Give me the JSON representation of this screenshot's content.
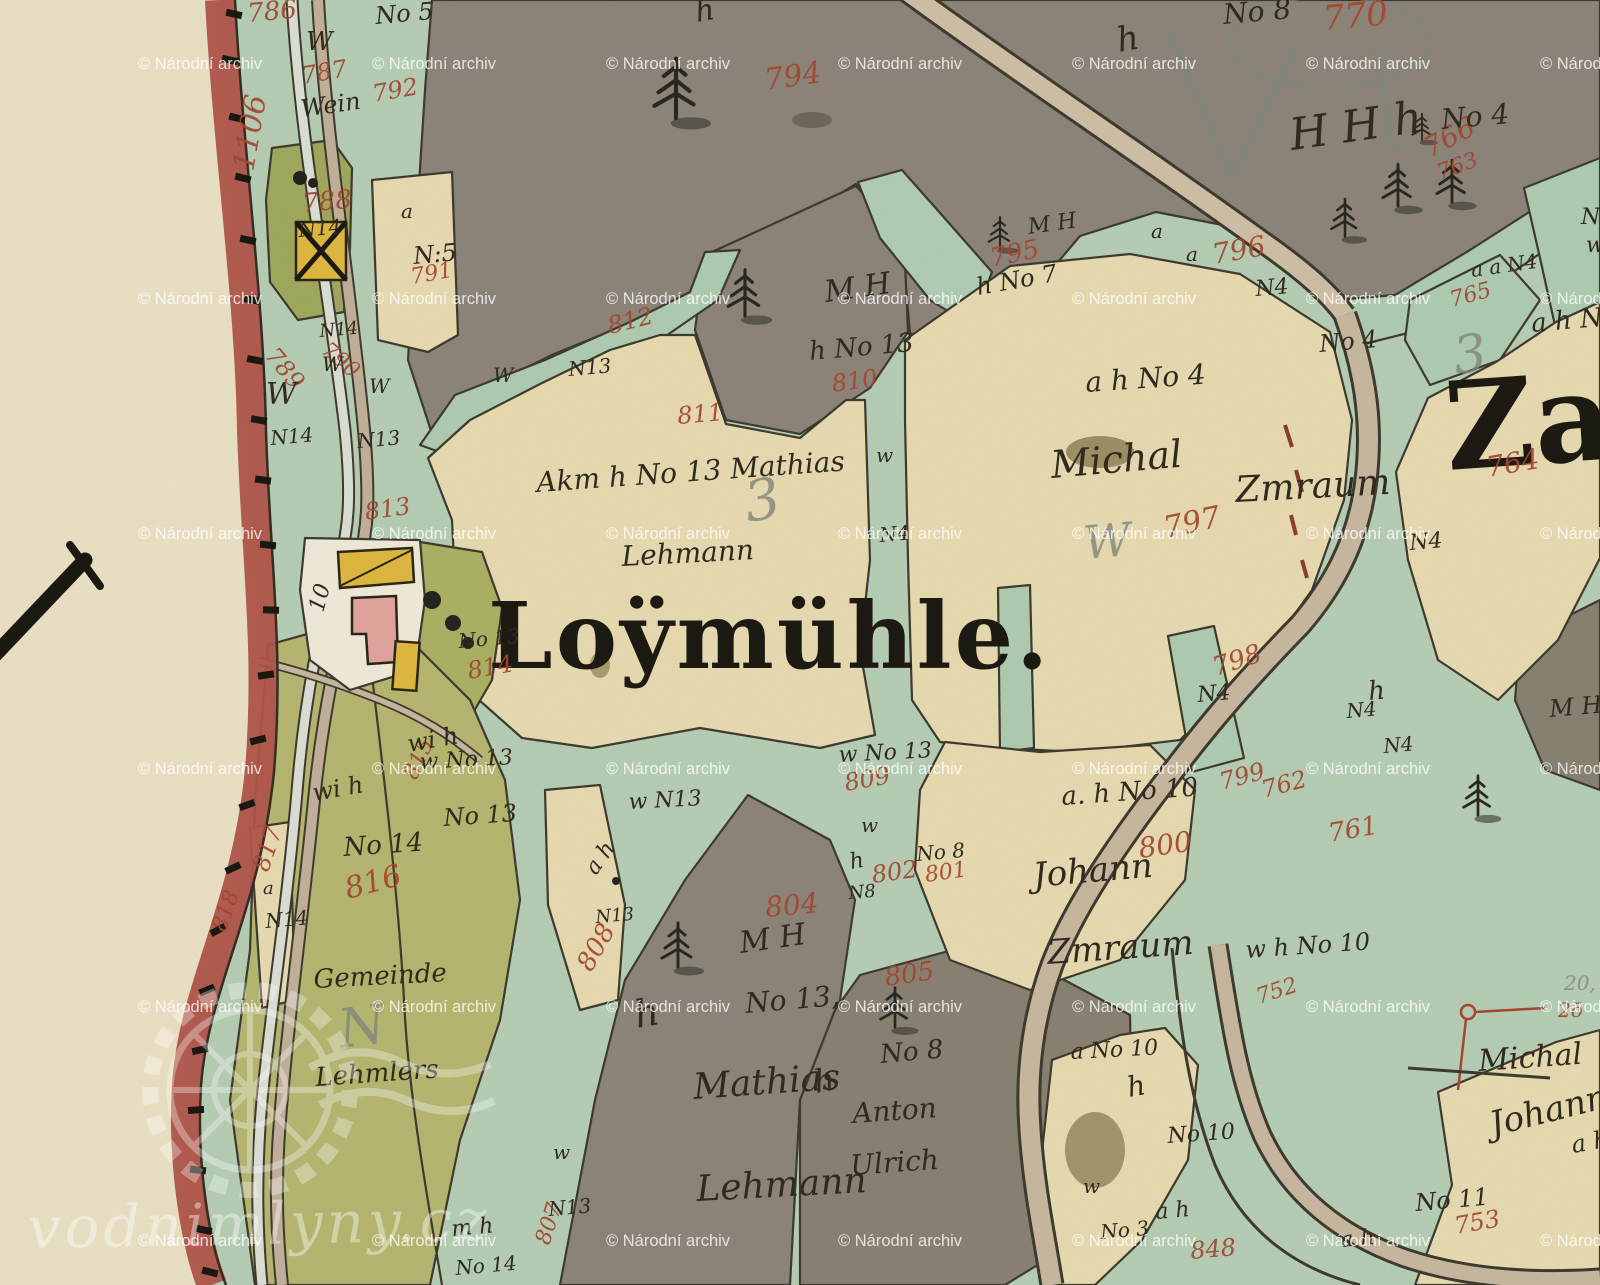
{
  "big": {
    "main": "Loÿmühle.",
    "right": "Zau",
    "left_sheet_numeral": "X"
  },
  "watermark": {
    "text": "© Národní archiv",
    "corner": "vodnimlyny.cz",
    "rows": [
      55,
      290,
      525,
      760,
      998,
      1232
    ],
    "cols": [
      138,
      372,
      606,
      838,
      1072,
      1306,
      1540
    ]
  },
  "colors": {
    "paper": "#ece3c6",
    "border_red": "#b05148",
    "meadow_teal": "#b6cfb6",
    "field_cream": "#e9dcb2",
    "forest_gray": "#8b8379",
    "olive": "#b5b76f",
    "olive_dark": "#9fa85c",
    "building_wood": "#e0b83e",
    "building_stone": "#e2a49e",
    "road_tan": "#c9b8a0",
    "ink": "#2b2619",
    "red_number": "#a4432b"
  },
  "labels": {
    "red": [
      {
        "t": "786",
        "x": 248,
        "y": 22,
        "s": 26,
        "r": -5
      },
      {
        "t": "787",
        "x": 303,
        "y": 84,
        "s": 24,
        "r": -10
      },
      {
        "t": "792",
        "x": 374,
        "y": 102,
        "s": 24,
        "r": -10
      },
      {
        "t": "1106",
        "x": 253,
        "y": 172,
        "s": 30,
        "r": -80
      },
      {
        "t": "788",
        "x": 303,
        "y": 212,
        "s": 26,
        "r": -5
      },
      {
        "t": "791",
        "x": 412,
        "y": 284,
        "s": 22,
        "r": -10
      },
      {
        "t": "789",
        "x": 264,
        "y": 356,
        "s": 24,
        "r": 50
      },
      {
        "t": "790",
        "x": 320,
        "y": 352,
        "s": 22,
        "r": 40
      },
      {
        "t": "813",
        "x": 366,
        "y": 520,
        "s": 24,
        "r": -8
      },
      {
        "t": "812",
        "x": 610,
        "y": 334,
        "s": 24,
        "r": -14
      },
      {
        "t": "811",
        "x": 678,
        "y": 424,
        "s": 24,
        "r": -5
      },
      {
        "t": "810",
        "x": 833,
        "y": 392,
        "s": 24,
        "r": -8
      },
      {
        "t": "794",
        "x": 766,
        "y": 90,
        "s": 30,
        "r": -8
      },
      {
        "t": "795",
        "x": 992,
        "y": 267,
        "s": 26,
        "r": -12
      },
      {
        "t": "796",
        "x": 1214,
        "y": 264,
        "s": 28,
        "r": -10
      },
      {
        "t": "770",
        "x": 1324,
        "y": 30,
        "s": 34,
        "r": -5
      },
      {
        "t": "766",
        "x": 1430,
        "y": 158,
        "s": 28,
        "r": -28
      },
      {
        "t": "763",
        "x": 1440,
        "y": 180,
        "s": 22,
        "r": -20
      },
      {
        "t": "765",
        "x": 1452,
        "y": 307,
        "s": 22,
        "r": -15
      },
      {
        "t": "764",
        "x": 1488,
        "y": 477,
        "s": 28,
        "r": -10
      },
      {
        "t": "797",
        "x": 1166,
        "y": 538,
        "s": 30,
        "r": -12
      },
      {
        "t": "798",
        "x": 1216,
        "y": 676,
        "s": 26,
        "r": -18
      },
      {
        "t": "799",
        "x": 1222,
        "y": 790,
        "s": 24,
        "r": -15
      },
      {
        "t": "762",
        "x": 1264,
        "y": 798,
        "s": 24,
        "r": -15
      },
      {
        "t": "761",
        "x": 1330,
        "y": 842,
        "s": 26,
        "r": -10
      },
      {
        "t": "800",
        "x": 1140,
        "y": 858,
        "s": 28,
        "r": -8
      },
      {
        "t": "802",
        "x": 873,
        "y": 883,
        "s": 24,
        "r": -8
      },
      {
        "t": "801",
        "x": 926,
        "y": 882,
        "s": 22,
        "r": -8
      },
      {
        "t": "809",
        "x": 846,
        "y": 791,
        "s": 24,
        "r": -10
      },
      {
        "t": "804",
        "x": 766,
        "y": 917,
        "s": 28,
        "r": -5
      },
      {
        "t": "805",
        "x": 886,
        "y": 986,
        "s": 26,
        "r": -8
      },
      {
        "t": "808",
        "x": 591,
        "y": 973,
        "s": 26,
        "r": -60
      },
      {
        "t": "816",
        "x": 348,
        "y": 899,
        "s": 30,
        "r": -15
      },
      {
        "t": "817",
        "x": 268,
        "y": 873,
        "s": 24,
        "r": -72
      },
      {
        "t": "815",
        "x": 416,
        "y": 781,
        "s": 22,
        "r": -65
      },
      {
        "t": "818",
        "x": 225,
        "y": 933,
        "s": 22,
        "r": -70
      },
      {
        "t": "807",
        "x": 549,
        "y": 1246,
        "s": 22,
        "r": -72
      },
      {
        "t": "814",
        "x": 469,
        "y": 679,
        "s": 24,
        "r": -10
      },
      {
        "t": "848",
        "x": 1191,
        "y": 1259,
        "s": 24,
        "r": -5
      },
      {
        "t": "753",
        "x": 1456,
        "y": 1234,
        "s": 24,
        "r": -10
      },
      {
        "t": "752",
        "x": 1259,
        "y": 1004,
        "s": 22,
        "r": -18
      },
      {
        "t": "2ō",
        "x": 1558,
        "y": 1017,
        "s": 20,
        "r": 0
      }
    ],
    "ink": [
      {
        "t": "No 5",
        "x": 376,
        "y": 24,
        "s": 24,
        "r": -5
      },
      {
        "t": "W",
        "x": 306,
        "y": 50,
        "s": 26,
        "r": 0
      },
      {
        "t": "Wein",
        "x": 302,
        "y": 117,
        "s": 24,
        "r": -8
      },
      {
        "t": "N14",
        "x": 299,
        "y": 237,
        "s": 20,
        "r": -5
      },
      {
        "t": "a",
        "x": 401,
        "y": 218,
        "s": 20,
        "r": 0
      },
      {
        "t": "N:5",
        "x": 414,
        "y": 264,
        "s": 24,
        "r": -5
      },
      {
        "t": "N14",
        "x": 320,
        "y": 337,
        "s": 18,
        "r": -5
      },
      {
        "t": "W",
        "x": 322,
        "y": 371,
        "s": 20,
        "r": 0
      },
      {
        "t": "W",
        "x": 369,
        "y": 393,
        "s": 20,
        "r": 0
      },
      {
        "t": "W",
        "x": 266,
        "y": 404,
        "s": 30,
        "r": 0
      },
      {
        "t": "N14",
        "x": 271,
        "y": 445,
        "s": 20,
        "r": -5
      },
      {
        "t": "N13",
        "x": 358,
        "y": 448,
        "s": 20,
        "r": -5
      },
      {
        "t": "N13",
        "x": 569,
        "y": 376,
        "s": 20,
        "r": -5
      },
      {
        "t": "W",
        "x": 493,
        "y": 382,
        "s": 20,
        "r": 0
      },
      {
        "t": "h No 13",
        "x": 810,
        "y": 360,
        "s": 26,
        "r": -5
      },
      {
        "t": "M H",
        "x": 826,
        "y": 302,
        "s": 30,
        "r": -8
      },
      {
        "t": "M H",
        "x": 1029,
        "y": 234,
        "s": 22,
        "r": -8
      },
      {
        "t": "h No 7",
        "x": 978,
        "y": 295,
        "s": 24,
        "r": -10
      },
      {
        "t": "No 8",
        "x": 1224,
        "y": 24,
        "s": 28,
        "r": -5
      },
      {
        "t": "h",
        "x": 1119,
        "y": 52,
        "s": 34,
        "r": -10
      },
      {
        "t": "H H h",
        "x": 1292,
        "y": 150,
        "s": 44,
        "r": -8
      },
      {
        "t": "No 4",
        "x": 1442,
        "y": 129,
        "s": 28,
        "r": -5
      },
      {
        "t": "a",
        "x": 1151,
        "y": 238,
        "s": 20,
        "r": 0
      },
      {
        "t": "a",
        "x": 1186,
        "y": 261,
        "s": 20,
        "r": 0
      },
      {
        "t": "N4",
        "x": 1256,
        "y": 296,
        "s": 22,
        "r": -5
      },
      {
        "t": "a a N4",
        "x": 1472,
        "y": 277,
        "s": 20,
        "r": -8
      },
      {
        "t": "N",
        "x": 1581,
        "y": 224,
        "s": 22,
        "r": 0
      },
      {
        "t": "w",
        "x": 1586,
        "y": 252,
        "s": 22,
        "r": 0
      },
      {
        "t": "a h N",
        "x": 1532,
        "y": 332,
        "s": 26,
        "r": -5
      },
      {
        "t": "No 4",
        "x": 1320,
        "y": 352,
        "s": 24,
        "r": -5
      },
      {
        "t": "a h No 4",
        "x": 1086,
        "y": 392,
        "s": 28,
        "r": -4
      },
      {
        "t": "Michal",
        "x": 1052,
        "y": 478,
        "s": 38,
        "r": -5
      },
      {
        "t": "Zmraum",
        "x": 1236,
        "y": 502,
        "s": 36,
        "r": -3
      },
      {
        "t": "Akm h No 13 Mathias",
        "x": 537,
        "y": 492,
        "s": 28,
        "r": -4
      },
      {
        "t": "Lehmann",
        "x": 622,
        "y": 566,
        "s": 28,
        "r": -3
      },
      {
        "t": "w",
        "x": 876,
        "y": 462,
        "s": 20,
        "r": 0
      },
      {
        "t": "N4",
        "x": 880,
        "y": 542,
        "s": 20,
        "r": -5
      },
      {
        "t": "N4",
        "x": 1198,
        "y": 702,
        "s": 22,
        "r": -5
      },
      {
        "t": "N4",
        "x": 1410,
        "y": 550,
        "s": 22,
        "r": -5
      },
      {
        "t": "h",
        "x": 1369,
        "y": 700,
        "s": 26,
        "r": -5
      },
      {
        "t": "N4",
        "x": 1347,
        "y": 718,
        "s": 20,
        "r": -5
      },
      {
        "t": "N4",
        "x": 1384,
        "y": 753,
        "s": 20,
        "r": -5
      },
      {
        "t": "M H",
        "x": 1550,
        "y": 717,
        "s": 24,
        "r": -5
      },
      {
        "t": "w No 13",
        "x": 420,
        "y": 769,
        "s": 22,
        "r": -3
      },
      {
        "t": "w N13",
        "x": 629,
        "y": 809,
        "s": 22,
        "r": -3
      },
      {
        "t": "w No 13",
        "x": 839,
        "y": 762,
        "s": 22,
        "r": -3
      },
      {
        "t": "a h",
        "x": 596,
        "y": 876,
        "s": 22,
        "r": -55
      },
      {
        "t": "N13",
        "x": 596,
        "y": 923,
        "s": 18,
        "r": -5
      },
      {
        "t": "w",
        "x": 861,
        "y": 832,
        "s": 20,
        "r": 0
      },
      {
        "t": "h",
        "x": 851,
        "y": 869,
        "s": 22,
        "r": -10
      },
      {
        "t": "N8",
        "x": 849,
        "y": 899,
        "s": 18,
        "r": -5
      },
      {
        "t": "No 8",
        "x": 917,
        "y": 861,
        "s": 20,
        "r": -5
      },
      {
        "t": "a. h No 10",
        "x": 1062,
        "y": 805,
        "s": 26,
        "r": -4
      },
      {
        "t": "Johann",
        "x": 1034,
        "y": 887,
        "s": 34,
        "r": -5
      },
      {
        "t": "Zmraum",
        "x": 1048,
        "y": 964,
        "s": 34,
        "r": -4
      },
      {
        "t": "w h No 10",
        "x": 1246,
        "y": 958,
        "s": 24,
        "r": -4
      },
      {
        "t": "h",
        "x": 637,
        "y": 1028,
        "s": 38,
        "r": -10
      },
      {
        "t": "No 13,",
        "x": 746,
        "y": 1013,
        "s": 28,
        "r": -5
      },
      {
        "t": "M H",
        "x": 741,
        "y": 953,
        "s": 30,
        "r": -8
      },
      {
        "t": "Mathias",
        "x": 694,
        "y": 1099,
        "s": 36,
        "r": -4
      },
      {
        "t": "Lehmann",
        "x": 697,
        "y": 1201,
        "s": 36,
        "r": -3
      },
      {
        "t": "h",
        "x": 816,
        "y": 1093,
        "s": 32,
        "r": -10
      },
      {
        "t": "No 8",
        "x": 881,
        "y": 1063,
        "s": 26,
        "r": -5
      },
      {
        "t": "Anton",
        "x": 853,
        "y": 1123,
        "s": 28,
        "r": -4
      },
      {
        "t": "Ulrich",
        "x": 851,
        "y": 1175,
        "s": 28,
        "r": -4
      },
      {
        "t": "wi h",
        "x": 409,
        "y": 752,
        "s": 24,
        "r": -10
      },
      {
        "t": "wi h",
        "x": 314,
        "y": 801,
        "s": 24,
        "r": -10
      },
      {
        "t": "No 14",
        "x": 344,
        "y": 856,
        "s": 26,
        "r": -4
      },
      {
        "t": "No 13",
        "x": 444,
        "y": 826,
        "s": 24,
        "r": -4
      },
      {
        "t": "a",
        "x": 263,
        "y": 894,
        "s": 18,
        "r": 0
      },
      {
        "t": "N14",
        "x": 266,
        "y": 928,
        "s": 20,
        "r": -5
      },
      {
        "t": "Gemeinde",
        "x": 314,
        "y": 988,
        "s": 26,
        "r": -3
      },
      {
        "t": "Lehmlers",
        "x": 316,
        "y": 1086,
        "s": 26,
        "r": -4
      },
      {
        "t": "No 13",
        "x": 459,
        "y": 648,
        "s": 20,
        "r": -5
      },
      {
        "t": "m h",
        "x": 452,
        "y": 1236,
        "s": 22,
        "r": -5
      },
      {
        "t": "No 14",
        "x": 456,
        "y": 1275,
        "s": 20,
        "r": -5
      },
      {
        "t": "N13",
        "x": 549,
        "y": 1216,
        "s": 20,
        "r": -5
      },
      {
        "t": "w",
        "x": 553,
        "y": 1159,
        "s": 20,
        "r": 0
      },
      {
        "t": "a No 10",
        "x": 1071,
        "y": 1059,
        "s": 22,
        "r": -3
      },
      {
        "t": "h",
        "x": 1129,
        "y": 1097,
        "s": 28,
        "r": -10
      },
      {
        "t": "No 10",
        "x": 1168,
        "y": 1143,
        "s": 22,
        "r": -4
      },
      {
        "t": "w",
        "x": 1083,
        "y": 1193,
        "s": 20,
        "r": 0
      },
      {
        "t": "a h",
        "x": 1156,
        "y": 1219,
        "s": 22,
        "r": -5
      },
      {
        "t": "No 3",
        "x": 1101,
        "y": 1239,
        "s": 20,
        "r": -5
      },
      {
        "t": "No 11",
        "x": 1416,
        "y": 1211,
        "s": 24,
        "r": -5
      },
      {
        "t": "a h",
        "x": 1341,
        "y": 1247,
        "s": 22,
        "r": -5
      },
      {
        "t": "Michal",
        "x": 1479,
        "y": 1071,
        "s": 30,
        "r": -4
      },
      {
        "t": "Johann",
        "x": 1493,
        "y": 1136,
        "s": 34,
        "r": -14
      },
      {
        "t": "a h",
        "x": 1573,
        "y": 1153,
        "s": 24,
        "r": -10
      },
      {
        "t": "h",
        "x": 697,
        "y": 22,
        "s": 30,
        "r": -10
      },
      {
        "t": "10",
        "x": 323,
        "y": 613,
        "s": 22,
        "r": -75
      }
    ],
    "pencil": [
      {
        "t": "3",
        "x": 748,
        "y": 522,
        "s": 56,
        "r": -10
      },
      {
        "t": "W",
        "x": 1085,
        "y": 559,
        "s": 46,
        "r": -5
      },
      {
        "t": "3",
        "x": 1456,
        "y": 374,
        "s": 52,
        "r": -8
      },
      {
        "t": "N",
        "x": 341,
        "y": 1048,
        "s": 54,
        "r": -8
      },
      {
        "t": "20, 2",
        "x": 1564,
        "y": 990,
        "s": 20,
        "r": 0
      }
    ]
  },
  "trees": [
    [
      676,
      95,
      1.35
    ],
    [
      745,
      298,
      1.05
    ],
    [
      1000,
      236,
      0.7
    ],
    [
      1345,
      222,
      0.85
    ],
    [
      1398,
      190,
      0.95
    ],
    [
      1452,
      186,
      0.95
    ],
    [
      1422,
      130,
      0.6
    ],
    [
      678,
      950,
      1.0
    ],
    [
      895,
      1012,
      0.9
    ],
    [
      1478,
      800,
      0.9
    ]
  ],
  "border_ticks": [
    [
      234,
      14,
      12
    ],
    [
      230,
      60,
      12
    ],
    [
      237,
      118,
      14
    ],
    [
      243,
      178,
      14
    ],
    [
      248,
      240,
      12
    ],
    [
      252,
      300,
      10
    ],
    [
      255,
      360,
      10
    ],
    [
      259,
      420,
      10
    ],
    [
      263,
      480,
      8
    ],
    [
      268,
      545,
      6
    ],
    [
      271,
      610,
      2
    ],
    [
      266,
      675,
      -8
    ],
    [
      258,
      740,
      -14
    ],
    [
      247,
      805,
      -20
    ],
    [
      233,
      868,
      -25
    ],
    [
      218,
      930,
      -28
    ],
    [
      207,
      990,
      -22
    ],
    [
      200,
      1050,
      -12
    ],
    [
      196,
      1110,
      -4
    ],
    [
      198,
      1170,
      6
    ],
    [
      204,
      1230,
      12
    ],
    [
      210,
      1272,
      14
    ]
  ]
}
